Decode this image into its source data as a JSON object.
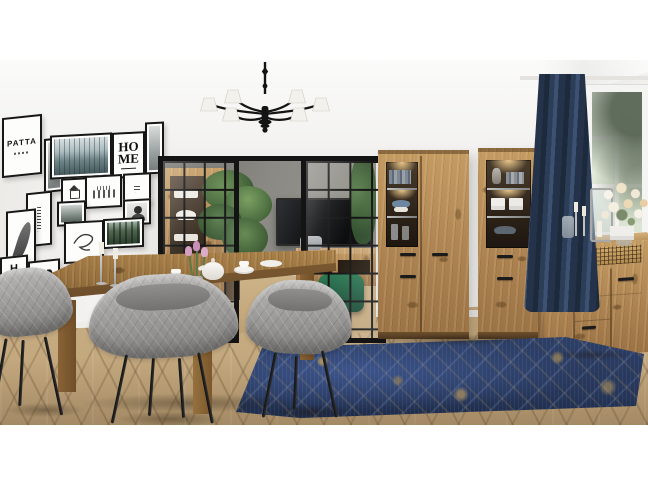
{
  "scene": {
    "type": "interior product photo",
    "room": "dining room with artisan oak furniture set",
    "style": "scandinavian-industrial",
    "photo_margins": {
      "top_px": 60,
      "bottom_px": 61
    }
  },
  "palette": {
    "background_white": "#ffffff",
    "wall": "#f2f1ee",
    "ceiling": "#fafaf9",
    "black_frame": "#151515",
    "oak_light": "#c49c64",
    "oak_mid": "#a87f4c",
    "table_oak": "#9b7543",
    "floor_oak": "#c4a97f",
    "chair_fabric": "#a4a4a2",
    "chair_legs": "#1c1c1c",
    "rug_navy": "#2c3f66",
    "rug_gold": "#c2a05e",
    "curtain_navy": "#2b3a52",
    "pouf_green": "#1f5c40",
    "tv_room_wall": "#8b8a85",
    "tv_screen": "#121212",
    "outdoor_green": "#dde7d6",
    "metal_silver": "#c6c6c4",
    "porcelain_white": "#f6f4f0",
    "tulip_pink": "#d49ec2"
  },
  "gallery_wall": {
    "frames_count": 16,
    "home_poster": {
      "line1": "HO",
      "line2": "ME"
    },
    "runes_poster": {
      "text": "PATTA"
    },
    "vertical_poster": {
      "text": "HOME"
    },
    "artworks": [
      "misty forest photo",
      "HOME typography",
      "runic typography",
      "feather sketch",
      "hummingbird sketch",
      "house line drawing",
      "city sketch",
      "text block poster",
      "forest road photo",
      "portrait photo",
      "forest with car photo",
      "letter posters"
    ]
  },
  "furniture": {
    "dining_table": "rectangular artisan oak dining table",
    "chairs": "gray quilted armchairs with black metal legs",
    "chairs_visible": 3,
    "display_cabinet_wide": "two-door oak display cabinet with lit glass section",
    "display_cabinet_narrow": "one-door oak display cabinet with lit glass section",
    "sideboard": "oak chest of drawers with woven lattice accent",
    "tv_room": [
      "wall-mounted TV",
      "oak media console",
      "green velvet pouf",
      "potted palm"
    ]
  },
  "decor": {
    "lighting": "black chandelier with white pleated shades",
    "tabletop": [
      "silver candlesticks with white candles",
      "white porcelain tea set",
      "pink tulips in glass vase"
    ],
    "sideboard_top": [
      "glass lantern",
      "candlesticks",
      "white flower bouquet",
      "glass bottles",
      "white box"
    ],
    "window": "white casement window with navy velvet curtain",
    "rug": "distressed navy and gold area rug",
    "floor": "light oak herringbone parquet"
  }
}
